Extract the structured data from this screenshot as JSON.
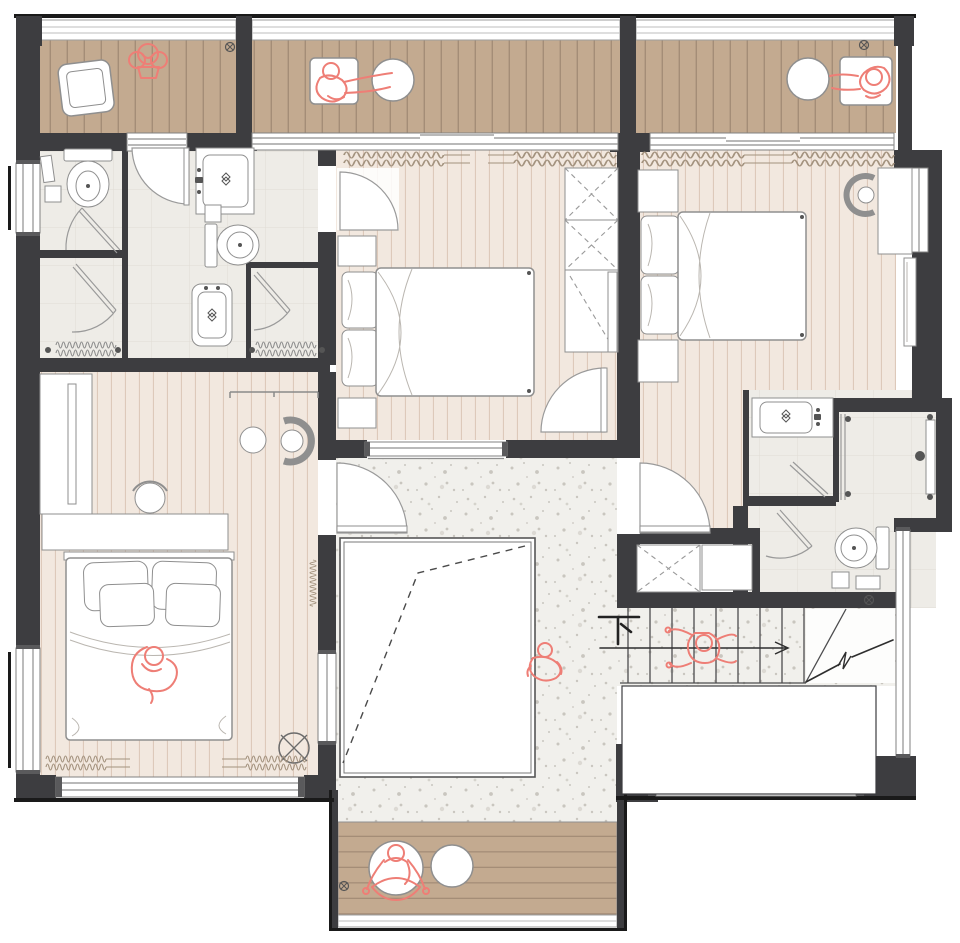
{
  "labels": {
    "stairs_down": "下"
  },
  "palette": {
    "wall": "#3d3d40",
    "outer_line": "#1a1a1a",
    "deck": "#c3aa90",
    "deck_line": "#a48d77",
    "floor_bedroom": "#f2e8df",
    "floor_stripe": "#ddc9ba",
    "floor_bath": "#eeece7",
    "tile_grid": "#e0dcd4",
    "floor_hall": "#f1f0ec",
    "speckle": "#c9c6bf",
    "furniture_stroke": "#8f8f8f",
    "figure_red": "#ee7e76",
    "curtain": "#a3927e",
    "annotation": "#2e2e2e"
  },
  "rooms": [
    {
      "id": "balcony-top-left",
      "kind": "balcony",
      "floor": "wood-deck"
    },
    {
      "id": "balcony-top-center",
      "kind": "balcony",
      "floor": "wood-deck"
    },
    {
      "id": "balcony-top-right",
      "kind": "balcony",
      "floor": "wood-deck"
    },
    {
      "id": "wc-left",
      "kind": "toilet-room",
      "floor": "tile"
    },
    {
      "id": "shower-left",
      "kind": "shower-room",
      "floor": "tile"
    },
    {
      "id": "bathroom-center",
      "kind": "bathroom",
      "floor": "tile"
    },
    {
      "id": "shower-center",
      "kind": "shower-room",
      "floor": "tile"
    },
    {
      "id": "bedroom-center",
      "kind": "bedroom",
      "floor": "plank"
    },
    {
      "id": "bedroom-right",
      "kind": "bedroom",
      "floor": "plank"
    },
    {
      "id": "bedroom-left",
      "kind": "bedroom",
      "floor": "plank"
    },
    {
      "id": "bathroom-right",
      "kind": "bathroom",
      "floor": "tile"
    },
    {
      "id": "hallway",
      "kind": "hall",
      "floor": "terrazzo"
    },
    {
      "id": "void-opening",
      "kind": "double-height-void"
    },
    {
      "id": "staircase",
      "kind": "stairs-down"
    },
    {
      "id": "balcony-bottom",
      "kind": "balcony",
      "floor": "wood-deck"
    }
  ],
  "figures": [
    {
      "id": "plant-sketch",
      "location": "balcony-top-left"
    },
    {
      "id": "person-seated-left",
      "location": "balcony-top-center"
    },
    {
      "id": "person-seated-right",
      "location": "balcony-top-right"
    },
    {
      "id": "person-sleeping",
      "location": "bedroom-left"
    },
    {
      "id": "person-at-railing",
      "location": "void-opening"
    },
    {
      "id": "person-on-stairs",
      "location": "staircase"
    },
    {
      "id": "person-yoga",
      "location": "balcony-bottom"
    }
  ],
  "fixtures": [
    "armchair",
    "round-table",
    "lounge-chair",
    "toilet",
    "wash-basin",
    "vanity-counter",
    "pedestal-sink",
    "shower-door",
    "shower-head",
    "bed-double",
    "pillow",
    "nightstand",
    "wardrobe",
    "mirror-panel",
    "desk",
    "stool",
    "reading-chair",
    "side-table",
    "closet",
    "stair-treads",
    "floor-drain",
    "ceiling-fan",
    "curtain",
    "window",
    "door-swing",
    "yoga-cushion",
    "bath-rug",
    "waste-bin"
  ]
}
